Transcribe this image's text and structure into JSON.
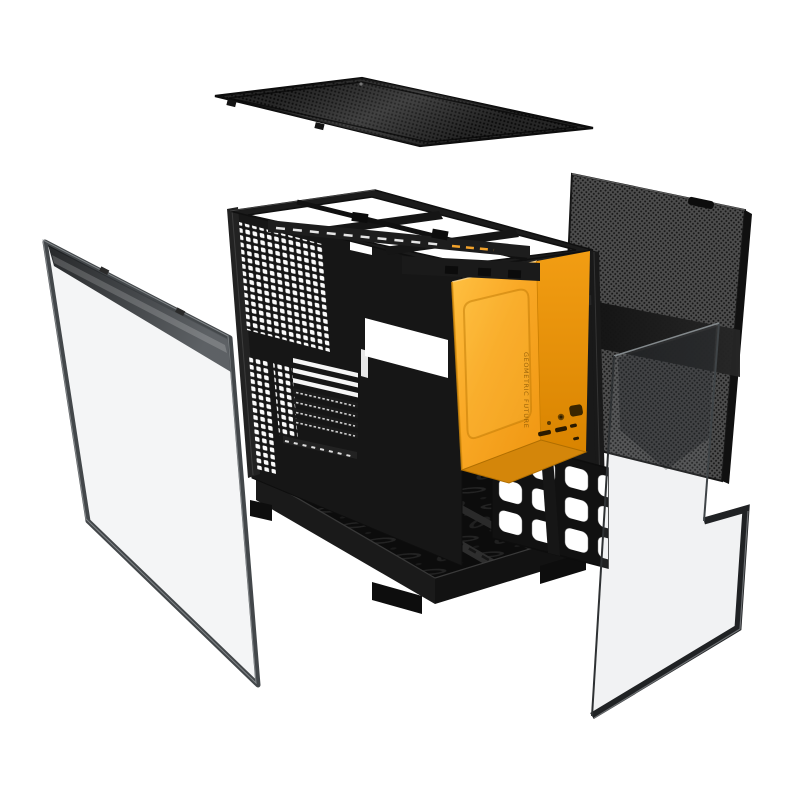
{
  "image": {
    "description": "Exploded-view product photo of a black ATX PC case with orange front panel",
    "background_color": "#ffffff"
  },
  "brand": {
    "vertical_logo_text": "GEOMETRIC FUTURE"
  },
  "colors": {
    "front_panel_orange_light": "#FFC244",
    "front_panel_orange": "#F9A825",
    "front_panel_orange_deep": "#EF9611",
    "front_panel_side_top": "#F29D13",
    "front_panel_side_bottom": "#D98400",
    "front_panel_underside": "#D4860A",
    "chassis_black": "#161616",
    "frame_dark": "#1b1b1b",
    "mesh_base_gray": "#4d4d4d",
    "mesh_dot": "#161616",
    "mesh_top_base": "#262626",
    "mesh_top_dot": "#0a0a0a",
    "glass_frame_gray": "#43474a",
    "glass_frame_black": "#202224",
    "glass_tint_left": "rgba(168,176,180,0.12)",
    "glass_tint_right": "rgba(150,158,163,0.13)"
  },
  "components": {
    "top_mesh_panel": "top-mesh-dust-filter",
    "side_mesh_panel": "side-mesh-panel",
    "left_glass_panel": "tempered-glass-side-panel-left",
    "right_glass_panel": "tempered-glass-side-panel-right",
    "chassis": "main-chassis-frame",
    "front_panel": "front-io-panel"
  }
}
